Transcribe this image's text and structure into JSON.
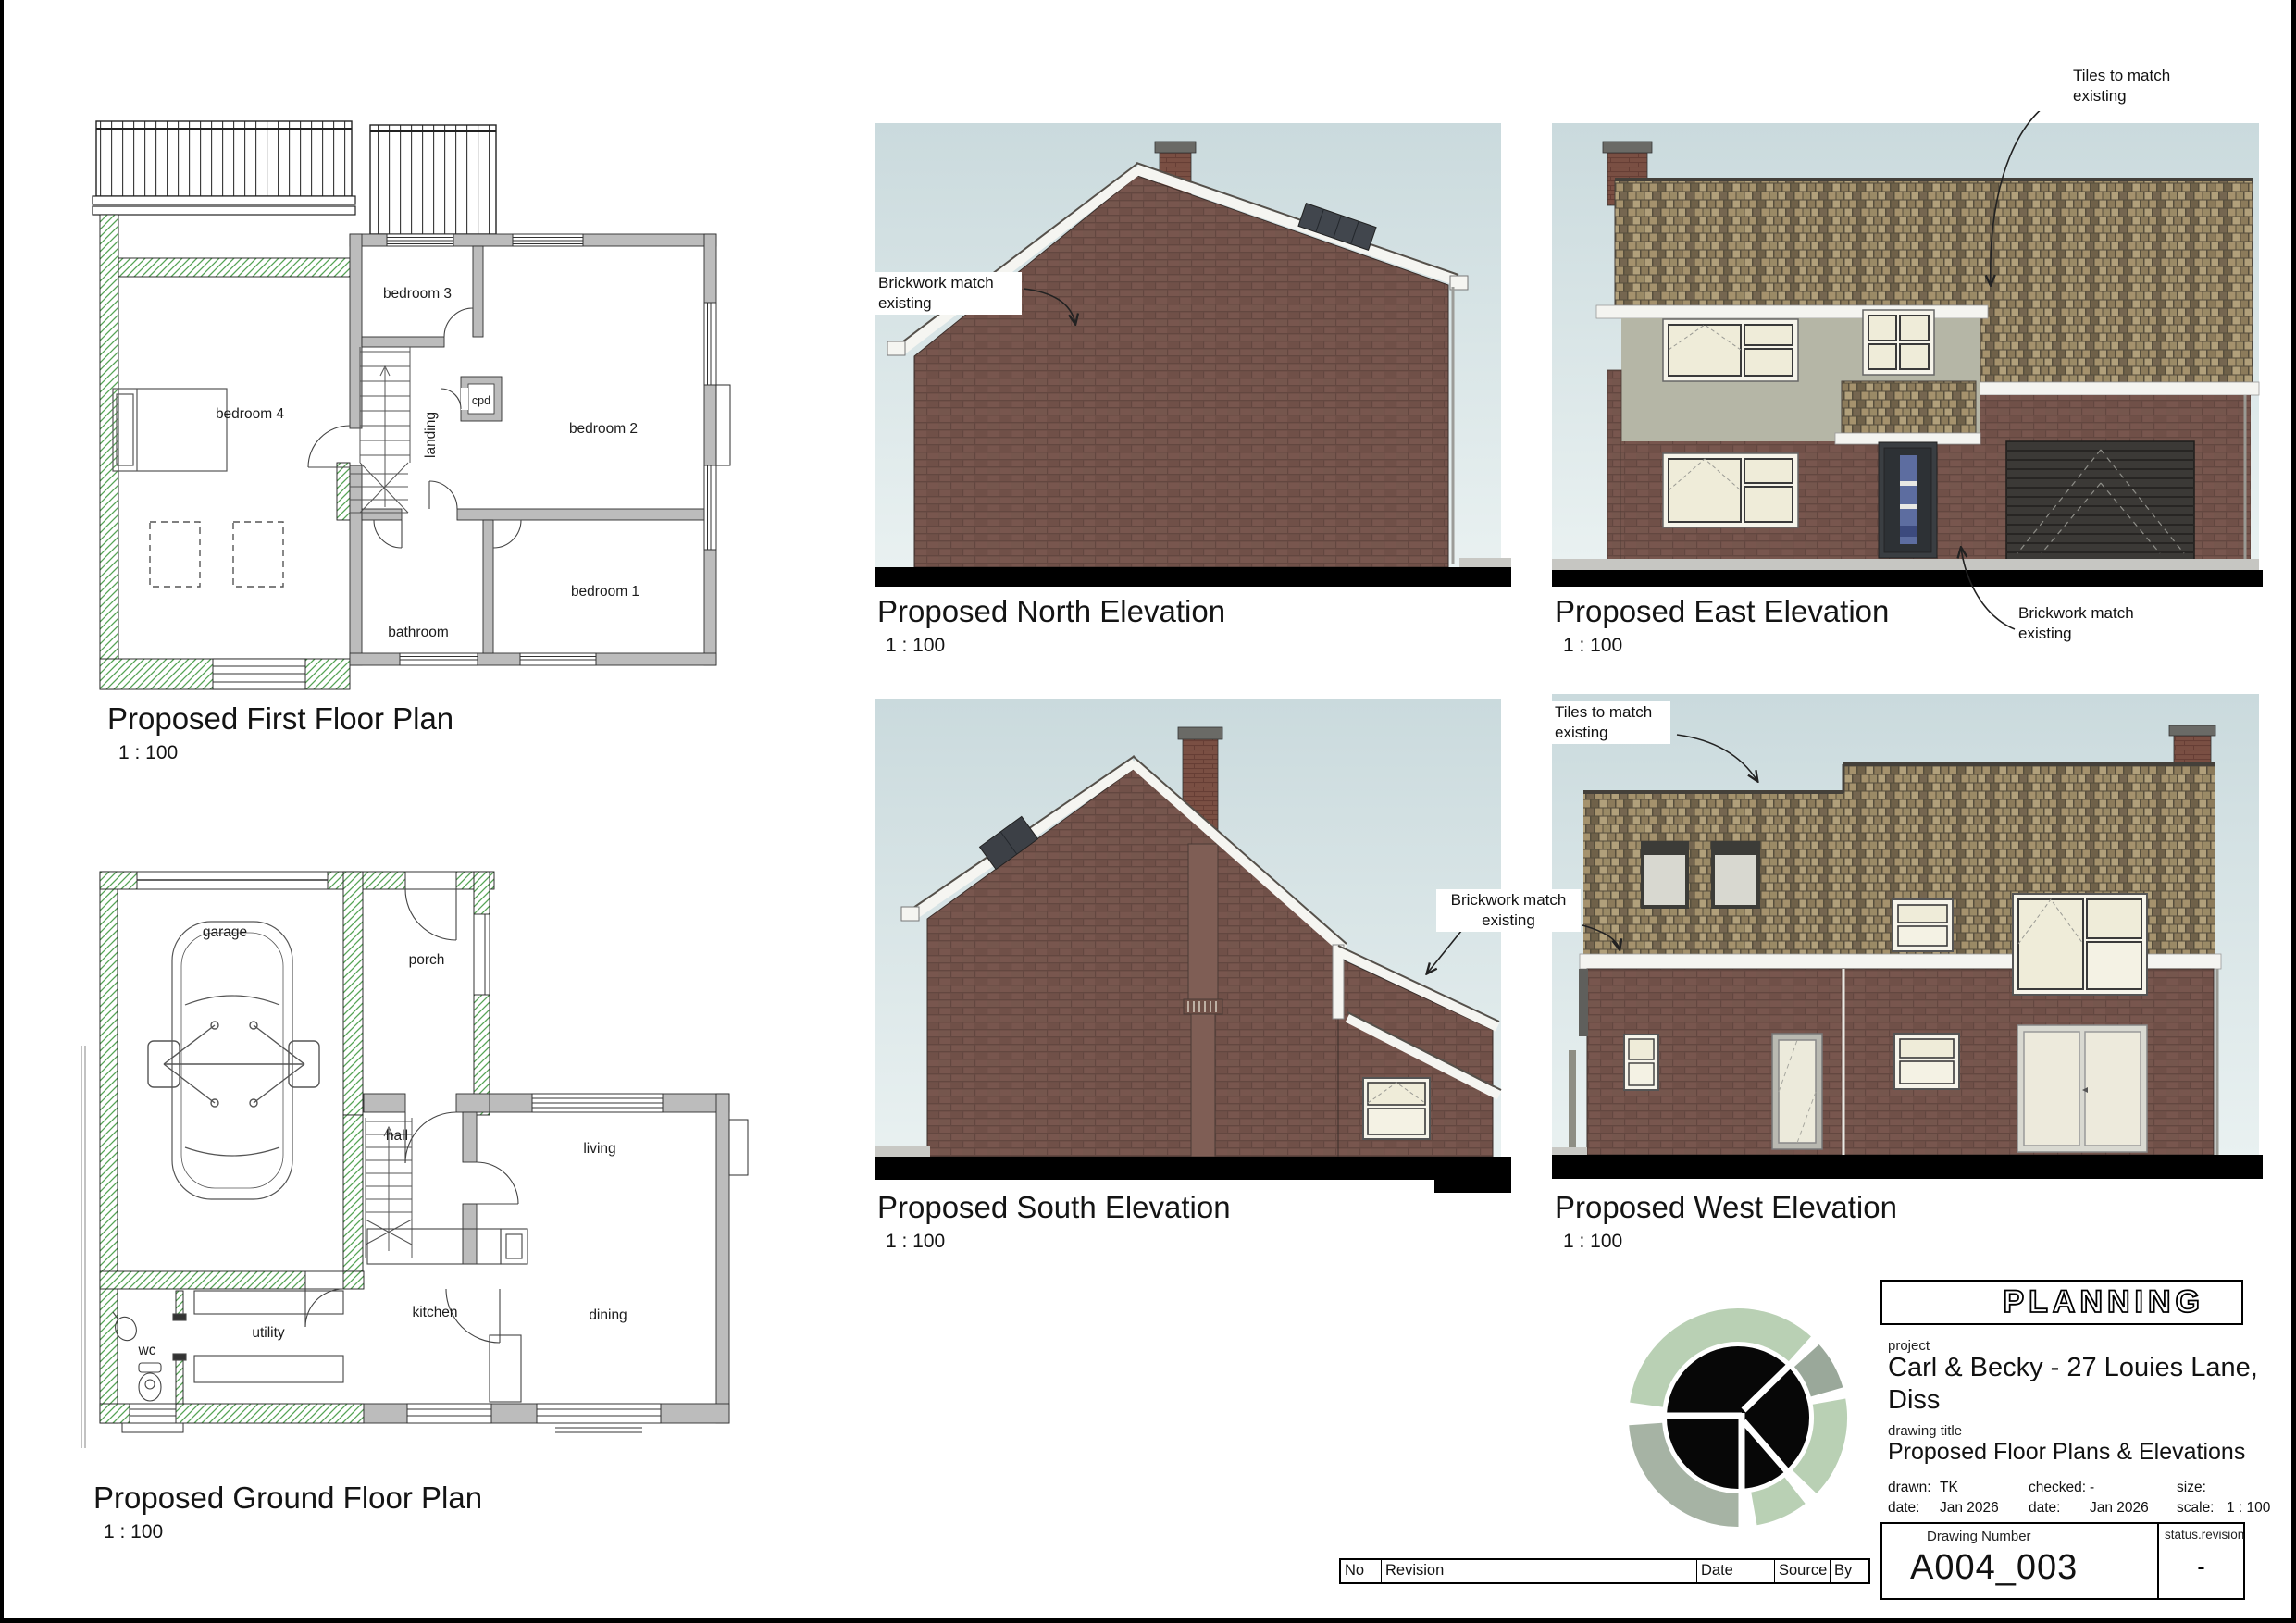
{
  "plans": {
    "first_floor": {
      "title": "Proposed First Floor Plan",
      "scale": "1 : 100",
      "rooms": {
        "bedroom4": "bedroom 4",
        "bedroom3": "bedroom 3",
        "bedroom2": "bedroom 2",
        "bedroom1": "bedroom 1",
        "bathroom": "bathroom",
        "cpd": "cpd",
        "landing": "landing"
      }
    },
    "ground_floor": {
      "title": "Proposed Ground Floor Plan",
      "scale": "1 : 100",
      "rooms": {
        "garage": "garage",
        "porch": "porch",
        "hall": "hall",
        "living": "living",
        "kitchen": "kitchen",
        "dining": "dining",
        "utility": "utility",
        "wc": "wc"
      }
    }
  },
  "elevations": {
    "north": {
      "title": "Proposed North Elevation",
      "scale": "1 : 100",
      "annotation_brick": "Brickwork match existing"
    },
    "east": {
      "title": "Proposed East Elevation",
      "scale": "1 : 100",
      "annotation_tiles": "Tiles to match existing",
      "annotation_brick": "Brickwork match existing"
    },
    "south": {
      "title": "Proposed South Elevation",
      "scale": "1 : 100"
    },
    "west": {
      "title": "Proposed West Elevation",
      "scale": "1 : 100",
      "annotation_tiles": "Tiles to match existing",
      "annotation_brick_shared": "Brickwork match existing"
    }
  },
  "title_block": {
    "stamp": "PLANNING",
    "project_label": "project",
    "project": "Carl & Becky - 27 Louies Lane,\nDiss",
    "drawing_title_label": "drawing title",
    "drawing_title": "Proposed Floor Plans & Elevations",
    "drawn_label": "drawn:",
    "drawn": "TK",
    "checked_label": "checked:",
    "checked": "-",
    "size_label": "size:",
    "size": "",
    "date_label": "date:",
    "date_drawn": "Jan 2026",
    "date_checked": "Jan 2026",
    "scale_label": "scale:",
    "scale": "1 : 100",
    "drawing_number_label": "Drawing Number",
    "drawing_number": "A004_003",
    "status_label": "status",
    "status_sep": ".",
    "revision_label": "revision",
    "revision": "-"
  },
  "revision_table": {
    "headers": [
      "No",
      "Revision",
      "Date",
      "Source",
      "By"
    ]
  },
  "colors": {
    "sky_top": "#cadadd",
    "sky_bottom": "#e9f1f1",
    "brick": "#78564e",
    "roof_tile": "#a5926d",
    "render": "#b5b6a6",
    "ground": "#000000",
    "new_wall_hatch": "#55a355",
    "existing_wall": "#bcbcbc",
    "logo_green_light": "#b9d0b4",
    "logo_green_grey": "#9aa89a",
    "logo_green_muted": "#a6b3a4"
  }
}
